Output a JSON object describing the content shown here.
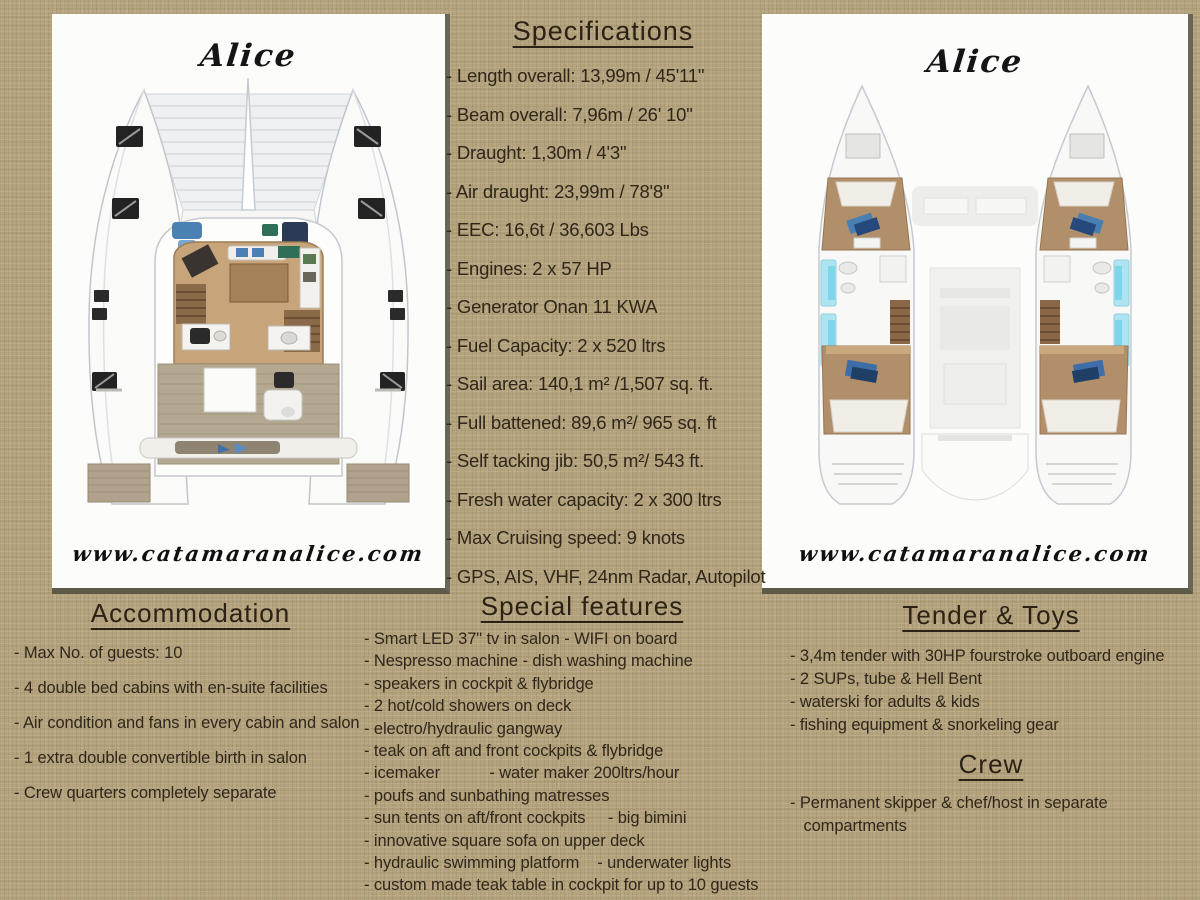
{
  "colors": {
    "background_burlap": "#b3a27c",
    "text": "#30261a",
    "panel_white": "#fcfcfb",
    "panel_shadow": "#5e5a48",
    "accent_blue": "#4a80b2",
    "teak_brown": "#c7a47a",
    "window_cyan": "#aee4f0"
  },
  "left_panel": {
    "boat_name": "Alice",
    "website": "www.catamaranalice.com",
    "image": "catamaran-deck-plan-top-view"
  },
  "right_panel": {
    "boat_name": "Alice",
    "website": "www.catamaranalice.com",
    "image": "catamaran-hulls-interior-plan"
  },
  "specifications": {
    "title": "Specifications",
    "items": [
      "- Length overall: 13,99m / 45'11\"",
      "- Beam overall: 7,96m / 26' 10\"",
      "- Draught: 1,30m / 4'3\"",
      "- Air draught: 23,99m / 78'8\"",
      "- EEC: 16,6t / 36,603 Lbs",
      "- Engines: 2 x 57 HP",
      "- Generator Onan 11 KWA",
      "- Fuel Capacity: 2 x 520 ltrs",
      "- Sail area: 140,1 m² /1,507 sq. ft.",
      "- Full battened: 89,6 m²/ 965 sq. ft",
      "- Self tacking jib: 50,5 m²/ 543 ft.",
      "- Fresh water capacity: 2 x 300 ltrs",
      "- Max Cruising speed: 9 knots",
      "- GPS, AIS, VHF, 24nm Radar, Autopilot"
    ]
  },
  "accommodation": {
    "title": "Accommodation",
    "items": [
      "- Max No. of guests: 10",
      "- 4 double bed cabins with en-suite facilities",
      "- Air condition and fans in every cabin and salon",
      "- 1 extra double convertible birth in salon",
      "- Crew quarters completely separate"
    ]
  },
  "special_features": {
    "title": "Special features",
    "items": [
      "- Smart LED 37\" tv in salon - WIFI on board",
      "- Nespresso machine - dish washing machine",
      "- speakers in cockpit & flybridge",
      "- 2 hot/cold showers on deck",
      "- electro/hydraulic gangway",
      "- teak on aft and front cockpits & flybridge",
      "- icemaker           - water maker 200ltrs/hour",
      "- poufs and sunbathing matresses",
      "- sun tents on aft/front cockpits     - big bimini",
      "- innovative square sofa on upper deck",
      "- hydraulic swimming platform    - underwater lights",
      "- custom made teak table in cockpit for up to 10 guests"
    ]
  },
  "tender_toys": {
    "title": "Tender & Toys",
    "items": [
      "- 3,4m tender with 30HP fourstroke outboard engine",
      "- 2 SUPs, tube & Hell Bent",
      "- waterski for adults & kids",
      "- fishing equipment & snorkeling gear"
    ]
  },
  "crew": {
    "title": "Crew",
    "items": [
      "- Permanent skipper & chef/host in separate\n   compartments"
    ]
  }
}
